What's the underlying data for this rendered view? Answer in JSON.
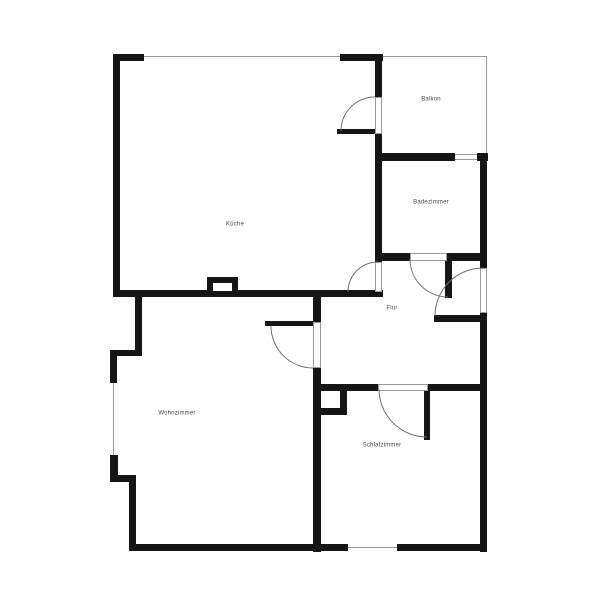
{
  "title": "Wohnungsgrundriss",
  "rooms": {
    "kueche": {
      "label": "Küche"
    },
    "balkon": {
      "label": "Balkon"
    },
    "badezimmer": {
      "label": "Badezimmer"
    },
    "flur": {
      "label": "Flur"
    },
    "wohnzimmer": {
      "label": "Wohnzimmer"
    },
    "schlafzimmer": {
      "label": "Schlafzimmer"
    }
  },
  "colors": {
    "wall": "#161616",
    "window_line": "#9a9a9a",
    "door_arc": "#707070",
    "label": "#4a4a4a",
    "background": "#ffffff"
  }
}
